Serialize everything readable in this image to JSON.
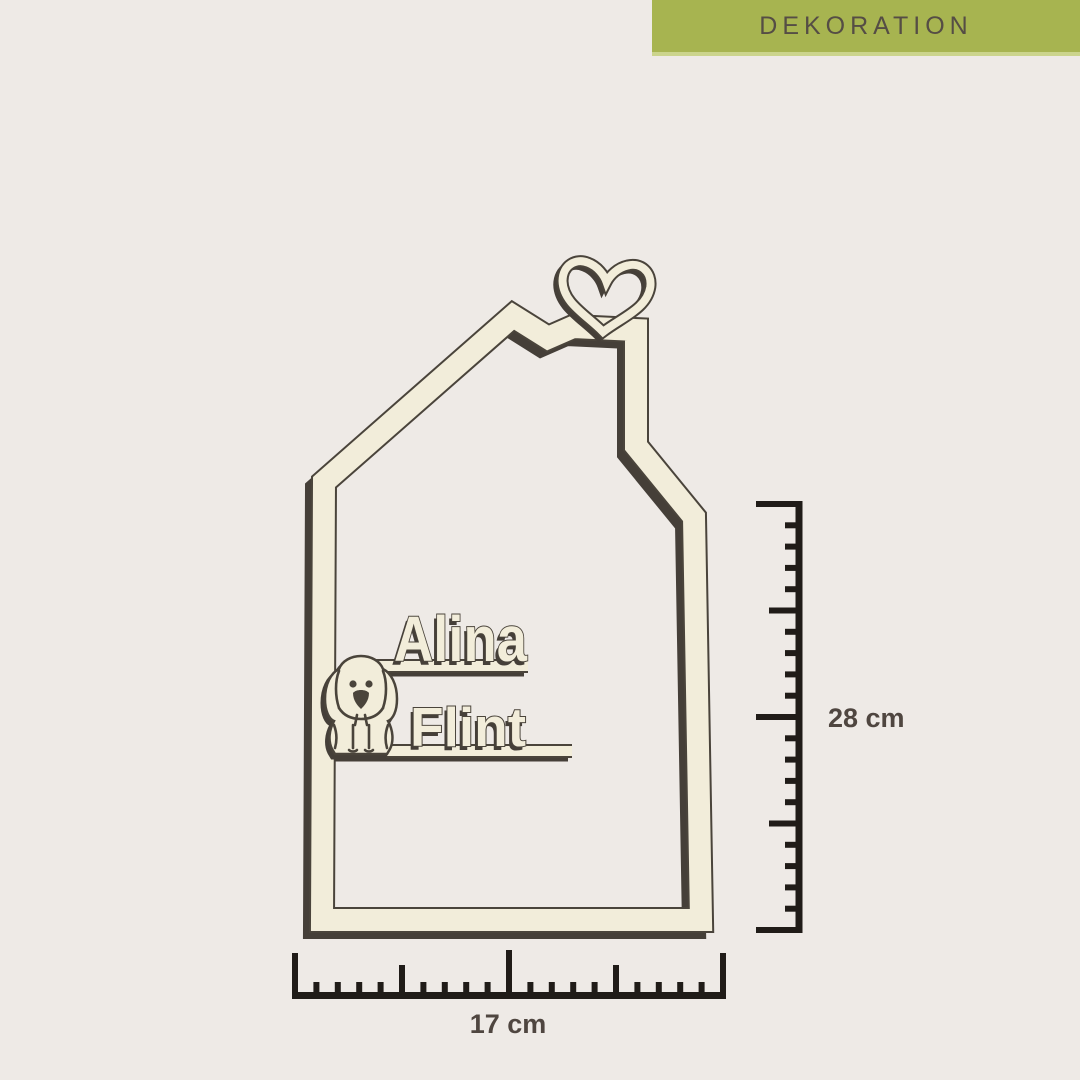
{
  "banner": {
    "label": "DEKORATION"
  },
  "artwork": {
    "type": "wooden-house-name-frame",
    "name_line1": "Alina",
    "name_line2": "Flint",
    "icons": {
      "heart": "heart-icon",
      "dog": "dog-icon"
    }
  },
  "measurements": {
    "height_label": "28 cm",
    "width_label": "17 cm"
  },
  "colors": {
    "background": "#eeeae6",
    "banner": "#a7b450",
    "banner_light": "#cbd48c",
    "banner_text": "#554d45",
    "wood": "#f2edda",
    "wood_edge": "#4a443b",
    "shadow": "#453f38",
    "ruler": "#201c18",
    "label_text": "#4f4640"
  }
}
